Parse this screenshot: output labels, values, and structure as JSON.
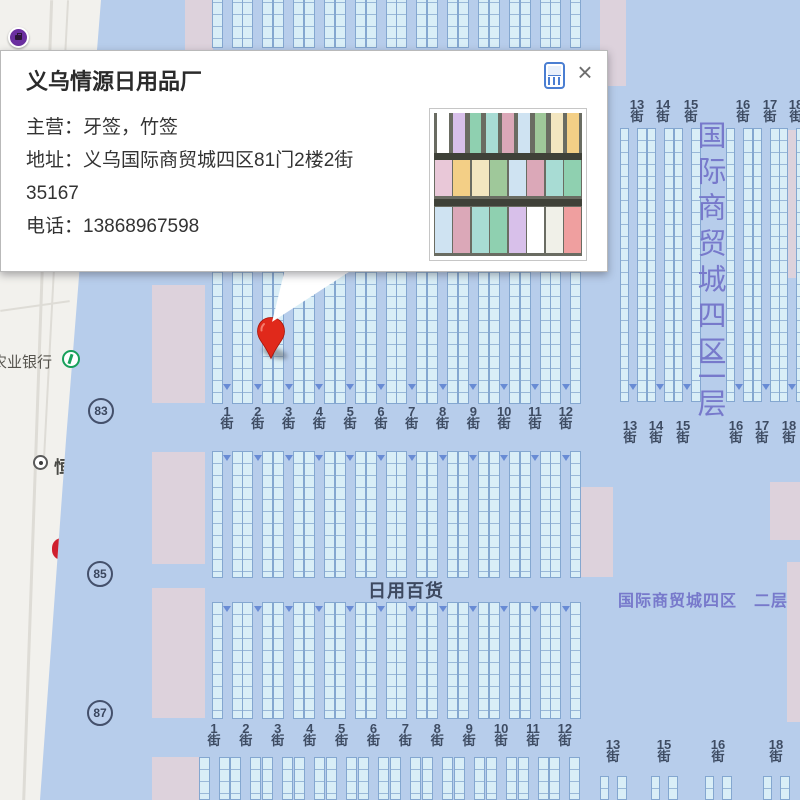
{
  "popup": {
    "title": "义乌情源日用品厂",
    "fields": [
      {
        "label": "主营：",
        "value": "牙签，竹签"
      },
      {
        "label": "地址：",
        "value": "义乌国际商贸城四区81门2楼2街35167"
      },
      {
        "label": "电话：",
        "value": "13868967598"
      }
    ],
    "close_label": "×"
  },
  "map": {
    "street_suffix": "街",
    "rows": {
      "top_right": [
        "13",
        "14",
        "15",
        "16",
        "17",
        "18"
      ],
      "mid_left": [
        "1",
        "2",
        "3",
        "4",
        "5",
        "6",
        "7",
        "8",
        "9",
        "10",
        "11",
        "12"
      ],
      "mid_right": [
        "13",
        "14",
        "15",
        "16",
        "17",
        "18"
      ],
      "bottom_left": [
        "1",
        "2",
        "3",
        "4",
        "5",
        "6",
        "7",
        "8",
        "9",
        "10",
        "11",
        "12"
      ],
      "bottom_right": [
        "13",
        "15",
        "16",
        "18"
      ]
    },
    "area_labels": {
      "vertical_building": "国际商贸城四区",
      "vertical_floor": "二层",
      "corridor_category": "日用百货",
      "corridor_building_floor": "国际商贸城四区　二层",
      "bank_poi": "农业银行",
      "partial_poi": "恒"
    },
    "gate_badges": [
      "83",
      "85",
      "87"
    ],
    "colors": {
      "floor": "#b7cdeb",
      "stall_fill": "#d9eef7",
      "stall_border": "#84a7d0",
      "pink_block": "#ddd2dc",
      "street_text": "#3e4c63",
      "purple_text": "#7779cb",
      "pin_red": "#e0291b",
      "street_area": "#f2f1ed"
    }
  }
}
